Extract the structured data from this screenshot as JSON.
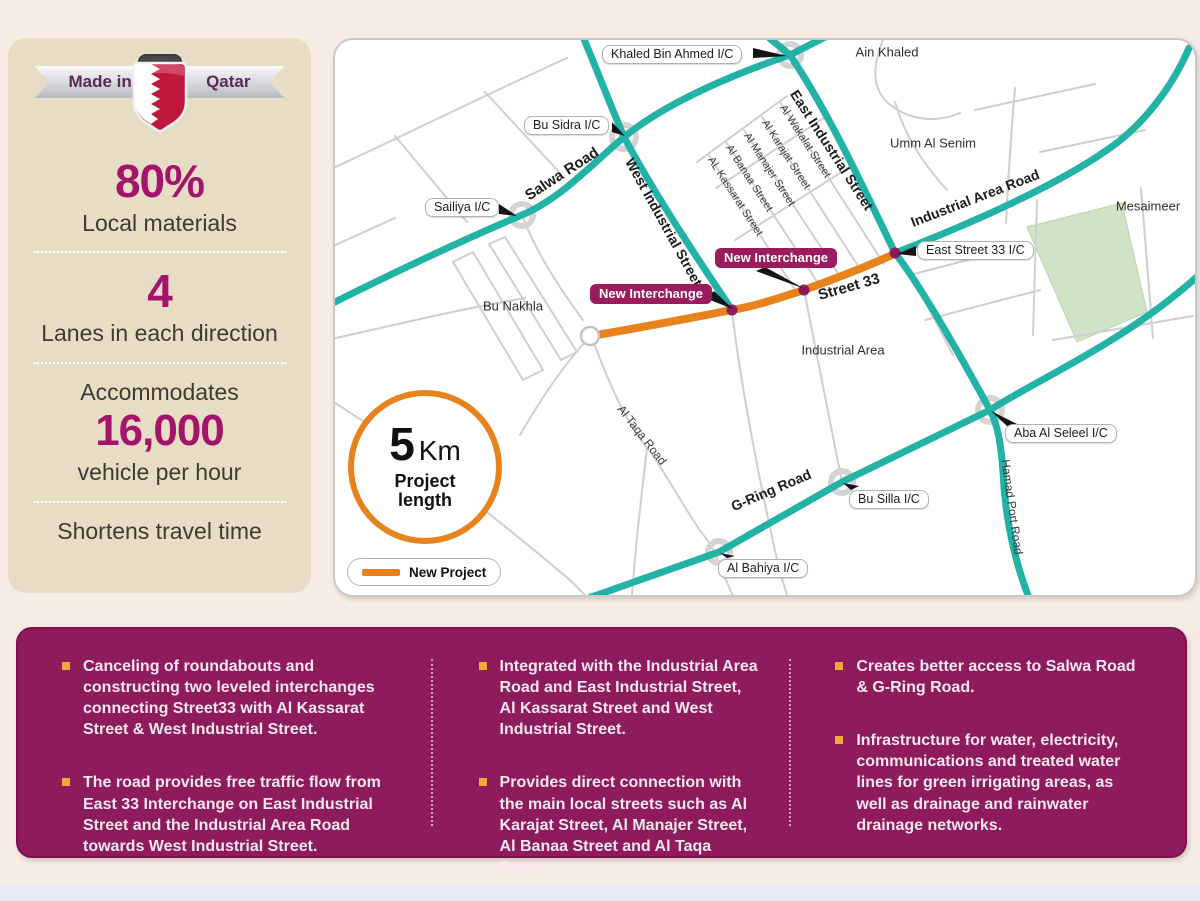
{
  "badge": {
    "left": "Made in",
    "right": "Qatar"
  },
  "sidebar": {
    "stat_materials": {
      "value": "80%",
      "label": "Local materials"
    },
    "stat_lanes": {
      "value": "4",
      "label": "Lanes in each direction"
    },
    "stat_capacity": {
      "pre": "Accommodates",
      "value": "16,000",
      "label": "vehicle per hour"
    },
    "stat_time": {
      "label": "Shortens travel time"
    }
  },
  "map": {
    "ic": [
      "Khaled Bin Ahmed I/C",
      "Bu Sidra I/C",
      "Sailiya I/C",
      "East Street 33 I/C",
      "Aba Al Seleel I/C",
      "Bu Silla I/C",
      "Al Bahiya I/C"
    ],
    "roads": [
      "Salwa Road",
      "West Industrial Street",
      "East Industrial Street",
      "Industrial Area Road",
      "G-Ring Road",
      "Hamad Port Road",
      "Al Taqa Road",
      "Street 33"
    ],
    "streets": [
      "Al Wakalat Street",
      "Al Karajat Street",
      "Al Manajer Street",
      "Al Banaa Street",
      "AL Kassarat Street"
    ],
    "areas": [
      "Ain Khaled",
      "Umm Al Senim",
      "Mesaimeer",
      "Bu Nakhla",
      "Industrial Area"
    ],
    "new_interchange": "New Interchange",
    "project_circle": {
      "value": "5",
      "unit": "Km",
      "caption": "Project length"
    },
    "legend": {
      "label": "New Project"
    }
  },
  "details": {
    "columns": [
      [
        "Canceling of roundabouts and constructing two leveled interchanges connecting Street33 with Al Kassarat Street & West Industrial Street.",
        "The road provides free traffic flow from East 33 Interchange on East Industrial Street and the Industrial Area Road towards West Industrial Street."
      ],
      [
        "Integrated with the Industrial Area Road and East Industrial Street, Al Kassarat Street and West Industrial Street.",
        "Provides direct connection with the main local streets such as Al Karajat Street, Al Manajer Street, Al Banaa Street and Al Taqa Street."
      ],
      [
        "Creates better access to Salwa Road & G-Ring Road.",
        "Infrastructure for water, electricity, communications and treated water lines for green irrigating areas, as well as drainage and rainwater drainage networks."
      ]
    ]
  },
  "colors": {
    "highway_teal": "#23b2a6",
    "project_orange": "#e8821d",
    "panel_magenta": "#8e1b5b",
    "badge_magenta": "#9c1b5f",
    "sidebar_beige": "#e7ddc4",
    "page_bg": "#f7ece5",
    "park_green": "#d0e3c6",
    "bullet_orange": "#f2a73d",
    "number_magenta": "#a4146c",
    "flag_crimson": "#c0173d"
  }
}
